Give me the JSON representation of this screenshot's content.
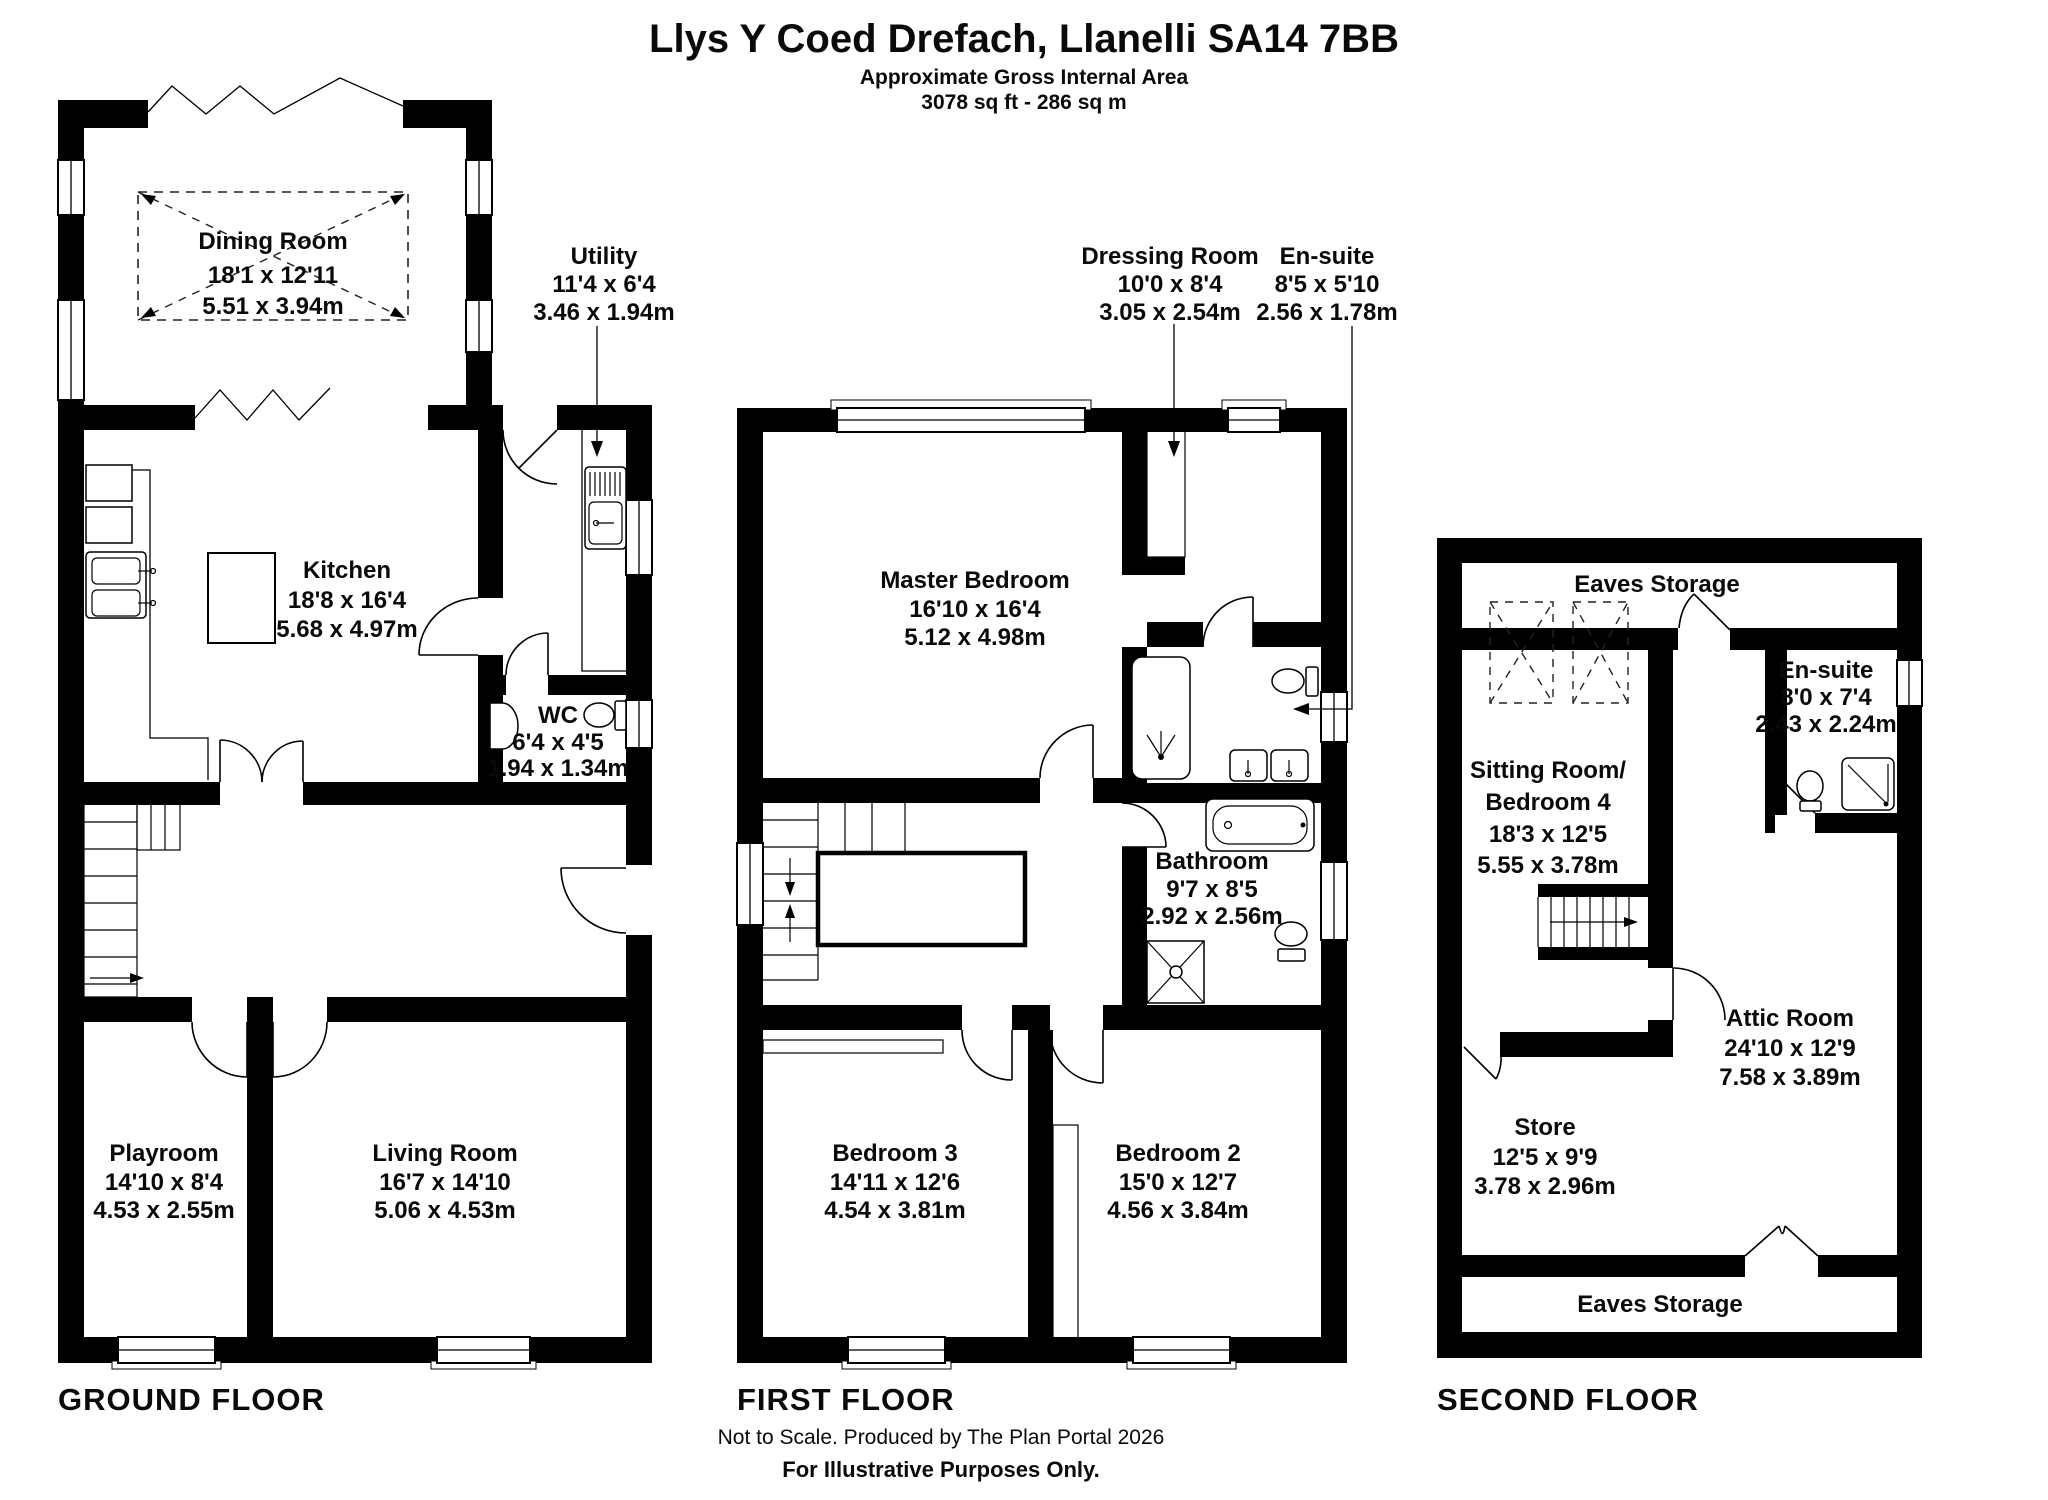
{
  "header": {
    "title": "Llys Y Coed Drefach, Llanelli SA14 7BB",
    "subtitle": "Approximate Gross Internal Area",
    "area": "3078 sq ft - 286 sq m"
  },
  "floor_labels": {
    "ground": "GROUND FLOOR",
    "first": "FIRST FLOOR",
    "second": "SECOND FLOOR"
  },
  "rooms": {
    "dining": {
      "name": "Dining Room",
      "imperial": "18'1 x 12'11",
      "metric": "5.51 x 3.94m"
    },
    "utility": {
      "name": "Utility",
      "imperial": "11'4 x 6'4",
      "metric": "3.46 x 1.94m"
    },
    "kitchen": {
      "name": "Kitchen",
      "imperial": "18'8 x 16'4",
      "metric": "5.68 x 4.97m"
    },
    "wc": {
      "name": "WC",
      "imperial": "6'4 x 4'5",
      "metric": "1.94 x 1.34m"
    },
    "playroom": {
      "name": "Playroom",
      "imperial": "14'10 x 8'4",
      "metric": "4.53 x 2.55m"
    },
    "living": {
      "name": "Living Room",
      "imperial": "16'7 x 14'10",
      "metric": "5.06 x 4.53m"
    },
    "dressing": {
      "name": "Dressing Room",
      "imperial": "10'0 x 8'4",
      "metric": "3.05 x 2.54m"
    },
    "ensuite1": {
      "name": "En-suite",
      "imperial": "8'5 x 5'10",
      "metric": "2.56 x 1.78m"
    },
    "master": {
      "name": "Master Bedroom",
      "imperial": "16'10 x 16'4",
      "metric": "5.12 x 4.98m"
    },
    "bathroom": {
      "name": "Bathroom",
      "imperial": "9'7 x 8'5",
      "metric": "2.92 x 2.56m"
    },
    "bedroom3": {
      "name": "Bedroom 3",
      "imperial": "14'11 x 12'6",
      "metric": "4.54 x 3.81m"
    },
    "bedroom2": {
      "name": "Bedroom 2",
      "imperial": "15'0 x 12'7",
      "metric": "4.56 x 3.84m"
    },
    "eaves_storage_top": {
      "name": "Eaves Storage"
    },
    "ensuite2": {
      "name": "En-suite",
      "imperial": "8'0 x 7'4",
      "metric": "2.43 x 2.24m"
    },
    "sitting": {
      "name_line1": "Sitting Room/",
      "name_line2": "Bedroom 4",
      "imperial": "18'3 x 12'5",
      "metric": "5.55 x 3.78m"
    },
    "attic": {
      "name": "Attic Room",
      "imperial": "24'10 x 12'9",
      "metric": "7.58 x 3.89m"
    },
    "store": {
      "name": "Store",
      "imperial": "12'5 x 9'9",
      "metric": "3.78 x 2.96m"
    },
    "eaves_storage_bottom": {
      "name": "Eaves Storage"
    }
  },
  "footer": {
    "line1": "Not to Scale. Produced by The Plan Portal 2026",
    "line2": "For Illustrative Purposes Only."
  },
  "colors": {
    "wall": "#000000",
    "background": "#ffffff",
    "text": "#0a0a0a"
  }
}
